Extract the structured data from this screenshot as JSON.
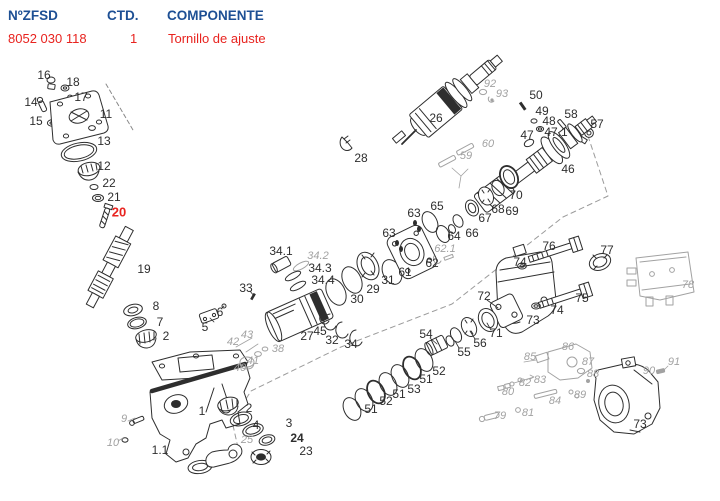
{
  "header": {
    "col_part_no": "NºZFSD",
    "col_qty": "CTD.",
    "col_component": "COMPONENTE",
    "row": {
      "part_number": "8052 030 118",
      "qty": "1",
      "component": "Tornillo de ajuste"
    }
  },
  "colors": {
    "blue": "#1d4f94",
    "red": "#e8231f",
    "ink": "#2e2e2e",
    "ghost": "#a2a2a2"
  },
  "diagram": {
    "description_labels_note": "exploded-view part numbers",
    "highlighted_part": "20",
    "labels": [
      {
        "t": "16",
        "x": 44,
        "y": 75,
        "s": "n"
      },
      {
        "t": "18",
        "x": 73,
        "y": 82,
        "s": "n"
      },
      {
        "t": "17",
        "x": 81,
        "y": 97,
        "s": "n"
      },
      {
        "t": "14",
        "x": 31,
        "y": 102,
        "s": "n"
      },
      {
        "t": "15",
        "x": 36,
        "y": 121,
        "s": "n"
      },
      {
        "t": "11",
        "x": 106,
        "y": 114,
        "s": "n"
      },
      {
        "t": "13",
        "x": 104,
        "y": 141,
        "s": "n"
      },
      {
        "t": "12",
        "x": 104,
        "y": 166,
        "s": "n"
      },
      {
        "t": "22",
        "x": 109,
        "y": 183,
        "s": "n"
      },
      {
        "t": "21",
        "x": 114,
        "y": 197,
        "s": "n"
      },
      {
        "t": "20",
        "x": 119,
        "y": 212,
        "s": "r"
      },
      {
        "t": "19",
        "x": 144,
        "y": 269,
        "s": "n"
      },
      {
        "t": "8",
        "x": 156,
        "y": 306,
        "s": "n"
      },
      {
        "t": "7",
        "x": 160,
        "y": 322,
        "s": "n"
      },
      {
        "t": "2",
        "x": 166,
        "y": 336,
        "s": "n"
      },
      {
        "t": "5",
        "x": 205,
        "y": 327,
        "s": "n"
      },
      {
        "t": "6",
        "x": 220,
        "y": 312,
        "s": "n"
      },
      {
        "t": "33",
        "x": 246,
        "y": 288,
        "s": "n"
      },
      {
        "t": "43",
        "x": 247,
        "y": 335,
        "s": "g"
      },
      {
        "t": "42",
        "x": 233,
        "y": 342,
        "s": "g"
      },
      {
        "t": "38",
        "x": 278,
        "y": 349,
        "s": "g"
      },
      {
        "t": "41",
        "x": 253,
        "y": 361,
        "s": "g"
      },
      {
        "t": "40",
        "x": 240,
        "y": 368,
        "s": "g"
      },
      {
        "t": "9",
        "x": 124,
        "y": 419,
        "s": "g"
      },
      {
        "t": "10",
        "x": 113,
        "y": 443,
        "s": "g"
      },
      {
        "t": "1",
        "x": 202,
        "y": 411,
        "s": "n"
      },
      {
        "t": "1.1",
        "x": 160,
        "y": 450,
        "s": "n"
      },
      {
        "t": "2",
        "x": 249,
        "y": 408,
        "s": "n"
      },
      {
        "t": "4",
        "x": 256,
        "y": 425,
        "s": "n"
      },
      {
        "t": "3",
        "x": 289,
        "y": 423,
        "s": "n"
      },
      {
        "t": "24",
        "x": 297,
        "y": 438,
        "s": "b"
      },
      {
        "t": "23",
        "x": 306,
        "y": 451,
        "s": "n"
      },
      {
        "t": "25",
        "x": 247,
        "y": 440,
        "s": "g"
      },
      {
        "t": "34.1",
        "x": 281,
        "y": 251,
        "s": "n"
      },
      {
        "t": "34.2",
        "x": 318,
        "y": 256,
        "s": "g"
      },
      {
        "t": "34.3",
        "x": 320,
        "y": 268,
        "s": "n"
      },
      {
        "t": "34.4",
        "x": 323,
        "y": 280,
        "s": "n"
      },
      {
        "t": "27",
        "x": 307,
        "y": 336,
        "s": "n"
      },
      {
        "t": "45",
        "x": 320,
        "y": 331,
        "s": "n"
      },
      {
        "t": "32",
        "x": 332,
        "y": 340,
        "s": "n"
      },
      {
        "t": "34",
        "x": 351,
        "y": 344,
        "s": "n"
      },
      {
        "t": "30",
        "x": 357,
        "y": 299,
        "s": "n"
      },
      {
        "t": "29",
        "x": 373,
        "y": 289,
        "s": "n"
      },
      {
        "t": "31",
        "x": 388,
        "y": 280,
        "s": "n"
      },
      {
        "t": "26",
        "x": 436,
        "y": 118,
        "s": "n"
      },
      {
        "t": "28",
        "x": 361,
        "y": 158,
        "s": "n"
      },
      {
        "t": "92",
        "x": 490,
        "y": 84,
        "s": "g"
      },
      {
        "t": "93",
        "x": 502,
        "y": 94,
        "s": "g"
      },
      {
        "t": "50",
        "x": 536,
        "y": 95,
        "s": "n"
      },
      {
        "t": "49",
        "x": 542,
        "y": 111,
        "s": "n"
      },
      {
        "t": "48",
        "x": 549,
        "y": 121,
        "s": "n"
      },
      {
        "t": "47",
        "x": 527,
        "y": 135,
        "s": "n"
      },
      {
        "t": "47.1",
        "x": 556,
        "y": 132,
        "s": "n"
      },
      {
        "t": "58",
        "x": 571,
        "y": 114,
        "s": "n"
      },
      {
        "t": "57",
        "x": 597,
        "y": 124,
        "s": "n"
      },
      {
        "t": "46",
        "x": 568,
        "y": 169,
        "s": "n"
      },
      {
        "t": "59",
        "x": 466,
        "y": 156,
        "s": "g"
      },
      {
        "t": "60",
        "x": 488,
        "y": 144,
        "s": "g"
      },
      {
        "t": "63",
        "x": 414,
        "y": 213,
        "s": "n"
      },
      {
        "t": "65",
        "x": 437,
        "y": 206,
        "s": "n"
      },
      {
        "t": "63",
        "x": 389,
        "y": 233,
        "s": "n"
      },
      {
        "t": "64",
        "x": 454,
        "y": 236,
        "s": "n"
      },
      {
        "t": "66",
        "x": 472,
        "y": 233,
        "s": "n"
      },
      {
        "t": "67",
        "x": 485,
        "y": 218,
        "s": "n"
      },
      {
        "t": "68",
        "x": 498,
        "y": 209,
        "s": "n"
      },
      {
        "t": "69",
        "x": 512,
        "y": 211,
        "s": "n"
      },
      {
        "t": "70",
        "x": 516,
        "y": 195,
        "s": "n"
      },
      {
        "t": "62",
        "x": 432,
        "y": 263,
        "s": "n"
      },
      {
        "t": "62.1",
        "x": 445,
        "y": 249,
        "s": "g"
      },
      {
        "t": "61",
        "x": 405,
        "y": 272,
        "s": "n"
      },
      {
        "t": "72",
        "x": 484,
        "y": 296,
        "s": "n"
      },
      {
        "t": "71",
        "x": 496,
        "y": 333,
        "s": "n"
      },
      {
        "t": "54",
        "x": 426,
        "y": 334,
        "s": "n"
      },
      {
        "t": "56",
        "x": 480,
        "y": 343,
        "s": "n"
      },
      {
        "t": "55",
        "x": 464,
        "y": 352,
        "s": "n"
      },
      {
        "t": "52",
        "x": 439,
        "y": 371,
        "s": "n"
      },
      {
        "t": "51",
        "x": 426,
        "y": 379,
        "s": "n"
      },
      {
        "t": "53",
        "x": 414,
        "y": 389,
        "s": "n"
      },
      {
        "t": "51",
        "x": 399,
        "y": 394,
        "s": "n"
      },
      {
        "t": "52",
        "x": 386,
        "y": 401,
        "s": "n"
      },
      {
        "t": "51",
        "x": 371,
        "y": 409,
        "s": "n"
      },
      {
        "t": "74",
        "x": 520,
        "y": 262,
        "s": "n"
      },
      {
        "t": "76",
        "x": 549,
        "y": 246,
        "s": "n"
      },
      {
        "t": "77",
        "x": 607,
        "y": 250,
        "s": "n"
      },
      {
        "t": "75",
        "x": 582,
        "y": 298,
        "s": "n"
      },
      {
        "t": "74",
        "x": 557,
        "y": 310,
        "s": "n"
      },
      {
        "t": "73",
        "x": 533,
        "y": 320,
        "s": "n"
      },
      {
        "t": "78",
        "x": 688,
        "y": 285,
        "s": "g"
      },
      {
        "t": "86",
        "x": 568,
        "y": 347,
        "s": "g"
      },
      {
        "t": "85",
        "x": 530,
        "y": 357,
        "s": "g"
      },
      {
        "t": "87",
        "x": 588,
        "y": 362,
        "s": "g"
      },
      {
        "t": "88",
        "x": 593,
        "y": 374,
        "s": "g"
      },
      {
        "t": "91",
        "x": 674,
        "y": 362,
        "s": "g"
      },
      {
        "t": "90",
        "x": 649,
        "y": 371,
        "s": "g"
      },
      {
        "t": "83",
        "x": 540,
        "y": 380,
        "s": "g"
      },
      {
        "t": "82",
        "x": 525,
        "y": 383,
        "s": "g"
      },
      {
        "t": "80",
        "x": 508,
        "y": 392,
        "s": "g"
      },
      {
        "t": "89",
        "x": 580,
        "y": 395,
        "s": "g"
      },
      {
        "t": "84",
        "x": 555,
        "y": 401,
        "s": "g"
      },
      {
        "t": "79",
        "x": 500,
        "y": 416,
        "s": "g"
      },
      {
        "t": "81",
        "x": 528,
        "y": 413,
        "s": "g"
      },
      {
        "t": "73",
        "x": 640,
        "y": 424,
        "s": "n"
      }
    ]
  }
}
